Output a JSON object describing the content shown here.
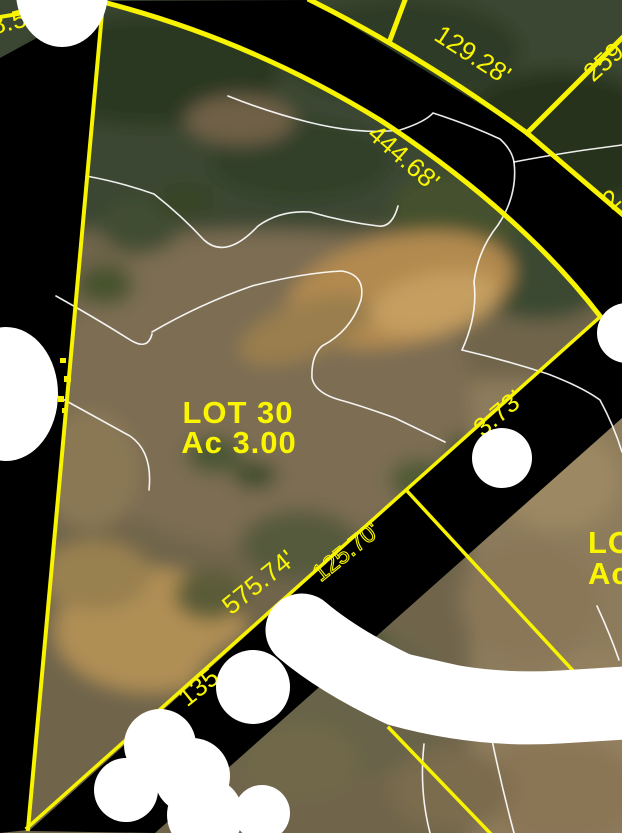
{
  "map": {
    "parcel": {
      "lot": "LOT 30",
      "acreage": "Ac 3.00"
    },
    "adjacent_parcel": {
      "lot": "LOT",
      "acreage": "Ac"
    },
    "dimensions": {
      "d_855": "8.55'",
      "d_12928": "129.28'",
      "d_259": "259.",
      "d_44468": "444.68'",
      "d_2frag": "2",
      "d_373": "3.73'",
      "d_12570": "125.70'",
      "d_57574": "575.74'",
      "d_135": "135"
    },
    "colors": {
      "boundary_line": "#f8f400",
      "label_text": "#f9f600",
      "road_mask": "#000000",
      "redaction_mask": "#ffffff",
      "contour_line": "#ffffff"
    }
  }
}
